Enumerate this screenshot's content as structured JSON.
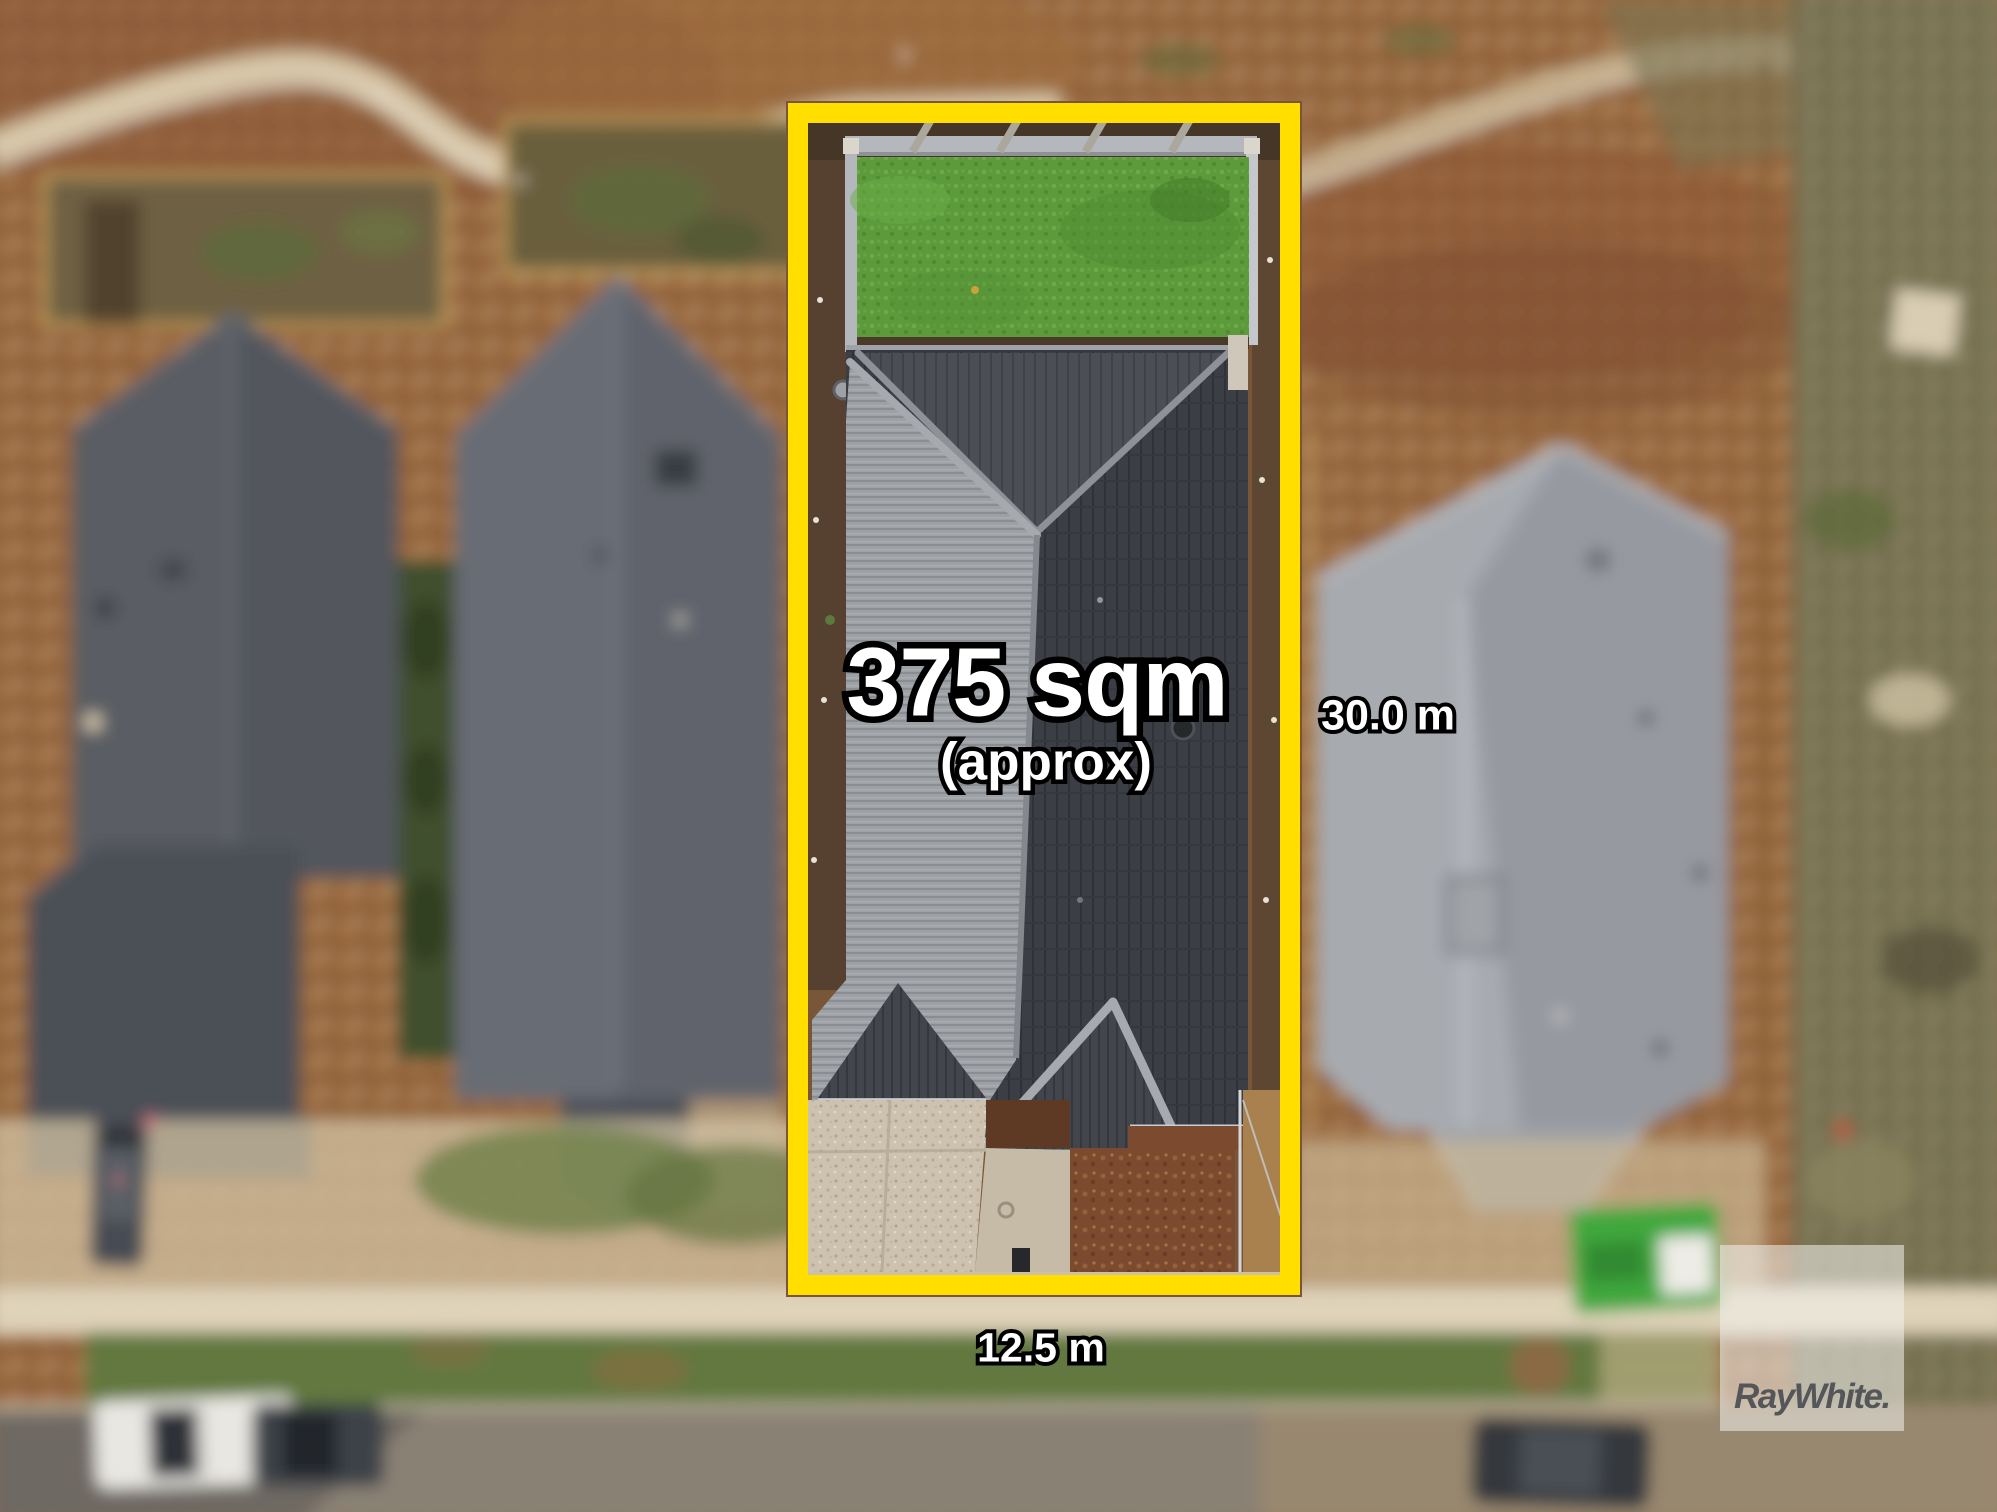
{
  "annotations": {
    "area": {
      "value": "375 sqm",
      "qualifier": "(approx)"
    },
    "depth_label": "30.0 m",
    "frontage_label": "12.5 m"
  },
  "branding": {
    "logo_text": "RayWhite."
  },
  "colors": {
    "boundary_yellow": "#FFDE00",
    "label_fill": "#FFFFFF",
    "label_outline": "#000000",
    "logo_text_gray": "#54565A",
    "logo_background": "rgba(243,242,239,0.55)"
  }
}
